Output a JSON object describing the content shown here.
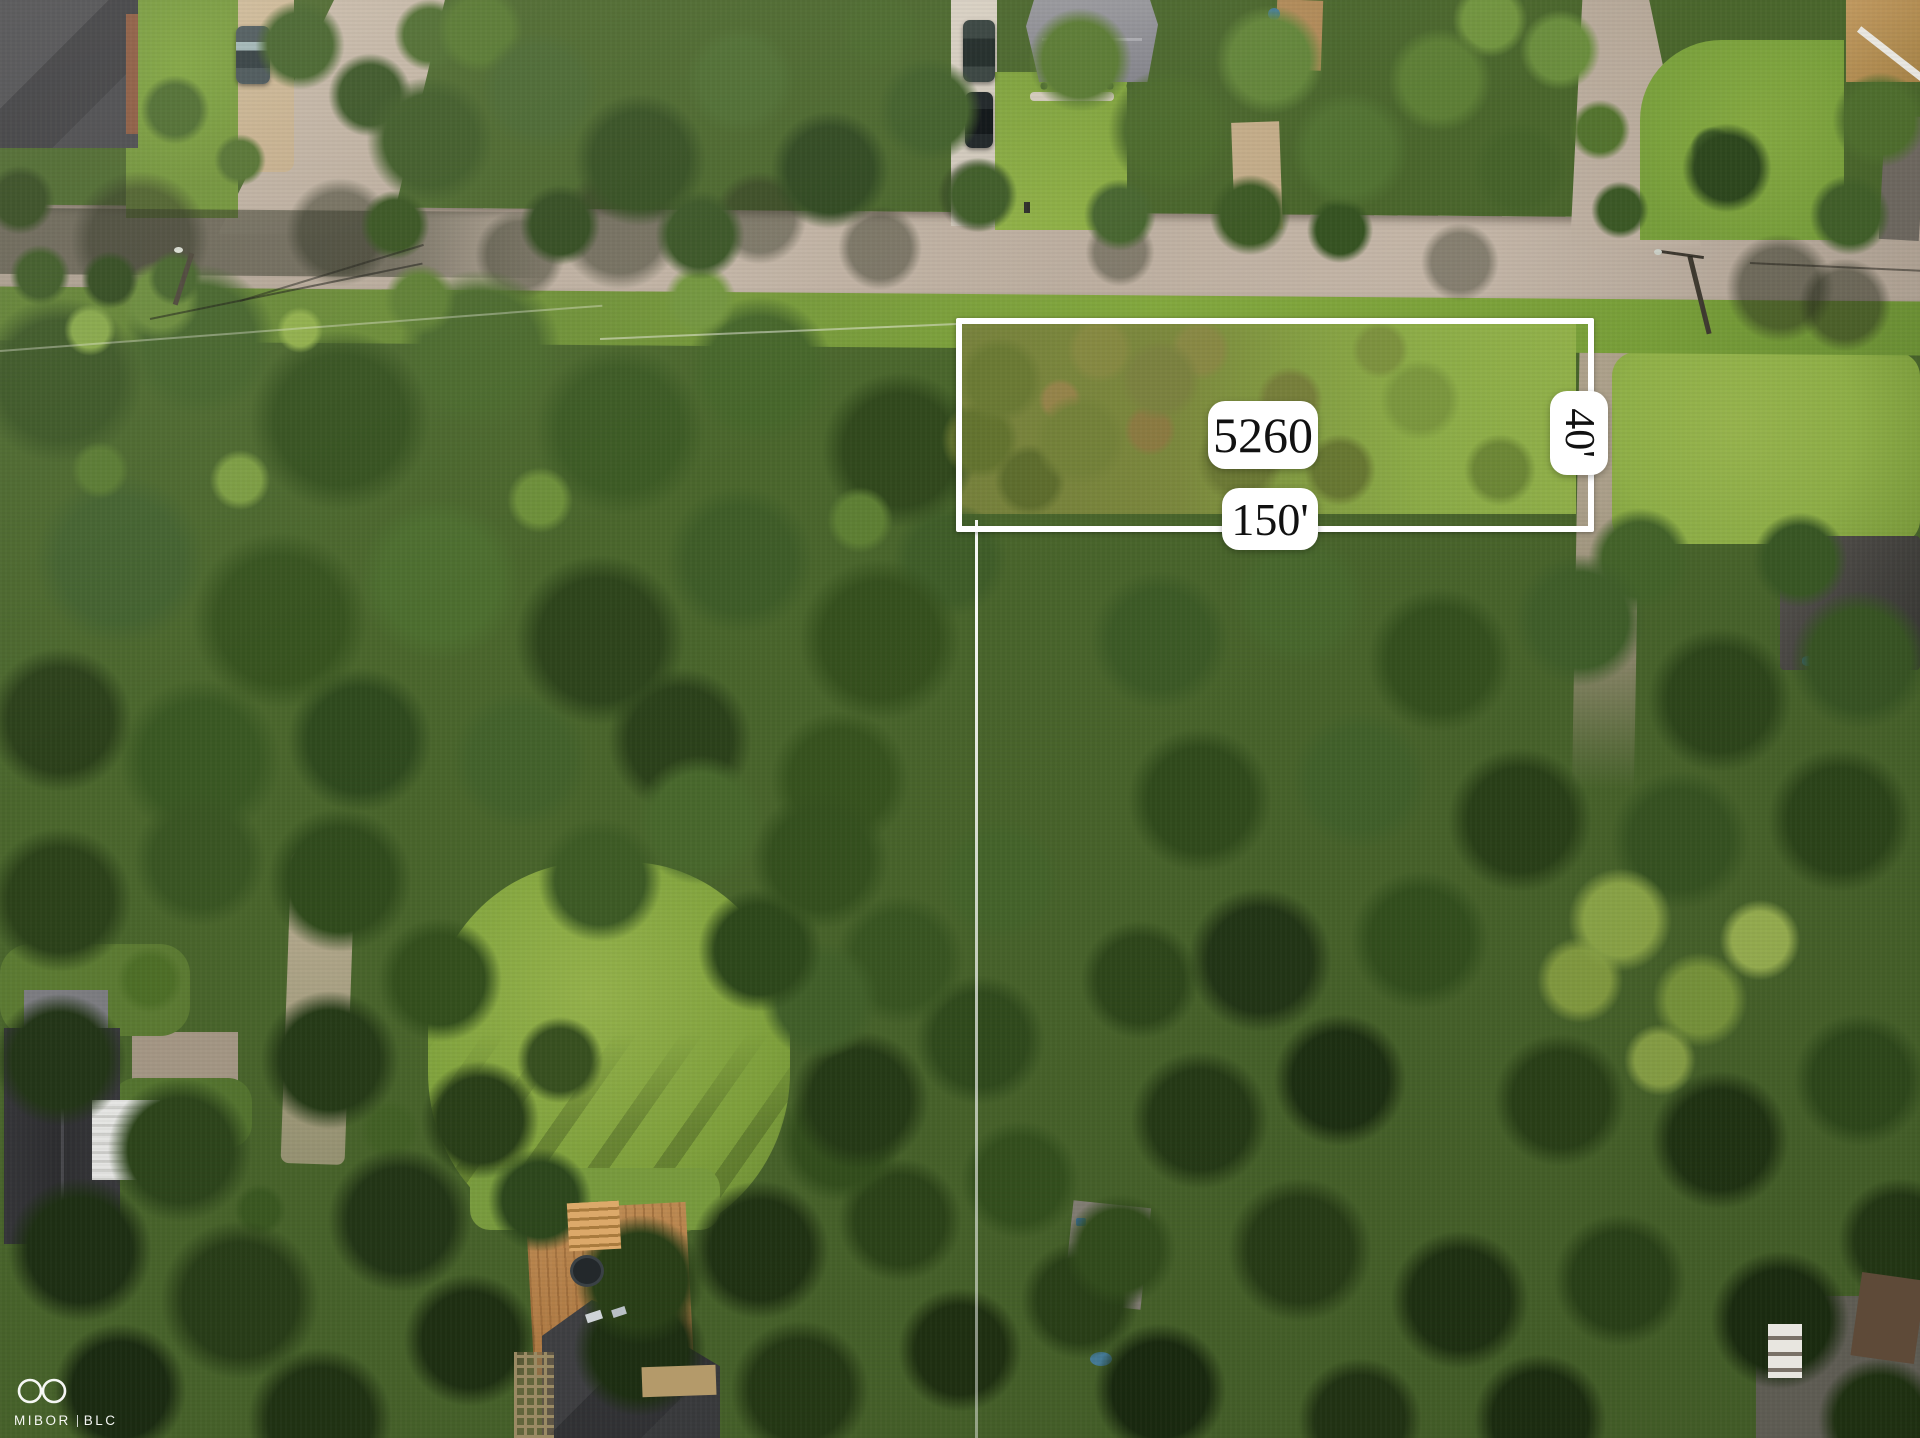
{
  "overlay": {
    "lot_number": "5260",
    "frontage_label": "150'",
    "depth_label": "40'",
    "line_color": "#ffffff",
    "label_background": "#ffffff",
    "label_text_color": "#111111"
  },
  "watermark": {
    "logo_icon": "infinity-icon",
    "text_primary": "MIBOR",
    "text_secondary": "BLC",
    "color": "#ffffff"
  },
  "scene": {
    "palette": {
      "canopy_dark": "#2c421a",
      "canopy_mid": "#44632a",
      "canopy_light": "#6d8f3a",
      "lawn_bright": "#8fb046",
      "scrub_olive": "#75833a",
      "road_asphalt": "#b5a899",
      "driveway_gravel": "#c9b493",
      "concrete": "#d6cec1",
      "roof_charcoal": "#3b3b3e",
      "roof_gray": "#8e8e93",
      "deck_wood": "#c08a52",
      "metal_roof_white": "#e9e9e7",
      "brick": "#8c5a40"
    }
  }
}
